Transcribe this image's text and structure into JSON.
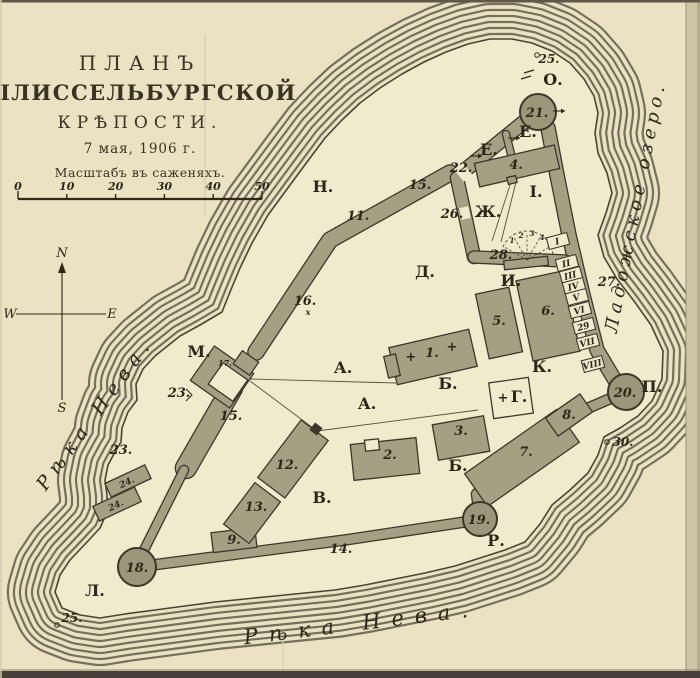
{
  "title": {
    "plan": "ПЛАНЪ",
    "fortress": "ШЛИССЕЛЬБУРГСКОЙ",
    "kreposti": "КРѢПОСТИ.",
    "date": "7 мая, 1906 г.",
    "scale_caption": "Масштабъ въ саженяхъ."
  },
  "scale_bar": {
    "ticks": [
      "0",
      "10",
      "20",
      "30",
      "40",
      "50"
    ]
  },
  "compass": {
    "letters": [
      {
        "t": "N",
        "x": 62,
        "y": 257
      },
      {
        "t": "E",
        "x": 112,
        "y": 318
      },
      {
        "t": "S",
        "x": 62,
        "y": 412
      },
      {
        "t": "W",
        "x": 10,
        "y": 318
      }
    ]
  },
  "water_labels": [
    {
      "name": "river-neva-left",
      "text": "Рѣка Нева.",
      "x": 100,
      "y": 417,
      "rot": -54,
      "size": 19,
      "spacing": 7
    },
    {
      "name": "river-neva-bottom",
      "text": "Рѣка Нева.",
      "x": 362,
      "y": 630,
      "rot": -7,
      "size": 21,
      "spacing": 11
    },
    {
      "name": "lake-ladoga",
      "text": "Ладожское озеро.",
      "x": 641,
      "y": 208,
      "rot": -79,
      "size": 18,
      "spacing": 5
    }
  ],
  "area_letters": [
    {
      "t": "А.",
      "x": 343,
      "y": 373
    },
    {
      "t": "А.",
      "x": 367,
      "y": 409
    },
    {
      "t": "Б.",
      "x": 448,
      "y": 389
    },
    {
      "t": "Б.",
      "x": 458,
      "y": 471
    },
    {
      "t": "В.",
      "x": 322,
      "y": 503
    },
    {
      "t": "Г.",
      "x": 519,
      "y": 402
    },
    {
      "t": "Д.",
      "x": 425,
      "y": 277
    },
    {
      "t": "Е.",
      "x": 489,
      "y": 155
    },
    {
      "t": "Е.",
      "x": 528,
      "y": 137
    },
    {
      "t": "Ж.",
      "x": 488,
      "y": 217
    },
    {
      "t": "И.",
      "x": 511,
      "y": 286
    },
    {
      "t": "І.",
      "x": 536,
      "y": 197
    },
    {
      "t": "К.",
      "x": 542,
      "y": 372
    },
    {
      "t": "Л.",
      "x": 95,
      "y": 596
    },
    {
      "t": "М.",
      "x": 199,
      "y": 357
    },
    {
      "t": "Н.",
      "x": 323,
      "y": 192
    },
    {
      "t": "О.",
      "x": 553,
      "y": 85
    },
    {
      "t": "П.",
      "x": 652,
      "y": 392
    },
    {
      "t": "Р.",
      "x": 496,
      "y": 546
    }
  ],
  "numbers": [
    {
      "t": "1.",
      "x": 432,
      "y": 357
    },
    {
      "t": "2.",
      "x": 390,
      "y": 459
    },
    {
      "t": "3.",
      "x": 461,
      "y": 435
    },
    {
      "t": "4.",
      "x": 516,
      "y": 169
    },
    {
      "t": "5.",
      "x": 499,
      "y": 325
    },
    {
      "t": "6.",
      "x": 548,
      "y": 315
    },
    {
      "t": "7.",
      "x": 526,
      "y": 456
    },
    {
      "t": "8.",
      "x": 569,
      "y": 419
    },
    {
      "t": "9.",
      "x": 234,
      "y": 544
    },
    {
      "t": "11.",
      "x": 358,
      "y": 220
    },
    {
      "t": "12.",
      "x": 287,
      "y": 469
    },
    {
      "t": "13.",
      "x": 256,
      "y": 511
    },
    {
      "t": "14.",
      "x": 341,
      "y": 553
    },
    {
      "t": "15.",
      "x": 420,
      "y": 189
    },
    {
      "t": "15.",
      "x": 231,
      "y": 420
    },
    {
      "t": "16.",
      "x": 305,
      "y": 305
    },
    {
      "t": "17.",
      "x": 225,
      "y": 366,
      "size": 8
    },
    {
      "t": "22.",
      "x": 461,
      "y": 172
    },
    {
      "t": "23.",
      "x": 179,
      "y": 397
    },
    {
      "t": "23.",
      "x": 121,
      "y": 454
    },
    {
      "t": "24.",
      "x": 128,
      "y": 485,
      "size": 9,
      "rot": -25
    },
    {
      "t": "24.",
      "x": 117,
      "y": 508,
      "size": 9,
      "rot": -25
    },
    {
      "t": "26.",
      "x": 452,
      "y": 218
    },
    {
      "t": "27.",
      "x": 609,
      "y": 286
    },
    {
      "t": "28.",
      "x": 501,
      "y": 259
    }
  ],
  "tower_labels": [
    {
      "t": "18.",
      "x": 137,
      "y": 572
    },
    {
      "t": "19.",
      "x": 479,
      "y": 524
    },
    {
      "t": "20.",
      "x": 625,
      "y": 397
    },
    {
      "t": "21.",
      "x": 537,
      "y": 117
    }
  ],
  "cells": [
    {
      "t": "I",
      "x": 558,
      "y": 241
    },
    {
      "t": "II",
      "x": 567,
      "y": 263
    },
    {
      "t": "III",
      "x": 571,
      "y": 275
    },
    {
      "t": "IV",
      "x": 574,
      "y": 286
    },
    {
      "t": "V",
      "x": 577,
      "y": 297
    },
    {
      "t": "VI",
      "x": 580,
      "y": 310
    },
    {
      "t": "29",
      "x": 584,
      "y": 326
    },
    {
      "t": "VII",
      "x": 588,
      "y": 342
    },
    {
      "t": "VIII",
      "x": 593,
      "y": 364
    }
  ],
  "point_markers": [
    {
      "t": "25.",
      "x": 549,
      "y": 63,
      "dx": 537,
      "dy": 55
    },
    {
      "t": "25.",
      "x": 72,
      "y": 622,
      "dx": 57,
      "dy": 625
    },
    {
      "t": "30.",
      "x": 623,
      "y": 446,
      "dx": 607,
      "dy": 442
    }
  ],
  "church_crosses": [
    {
      "x": 411,
      "y": 361
    },
    {
      "x": 452,
      "y": 351
    },
    {
      "x": 503,
      "y": 402
    }
  ],
  "fan_numbers": [
    {
      "t": "1",
      "x": 512,
      "y": 243
    },
    {
      "t": "2",
      "x": 521,
      "y": 238
    },
    {
      "t": "3",
      "x": 532,
      "y": 236
    },
    {
      "t": "4",
      "x": 542,
      "y": 240
    }
  ],
  "colors": {
    "paper": "#eae2c2",
    "island": "#f1eacc",
    "ink": "#2c2719",
    "wall_fill": "#a79f84",
    "wall_edge": "#3c362b",
    "ring": "#75705e"
  }
}
